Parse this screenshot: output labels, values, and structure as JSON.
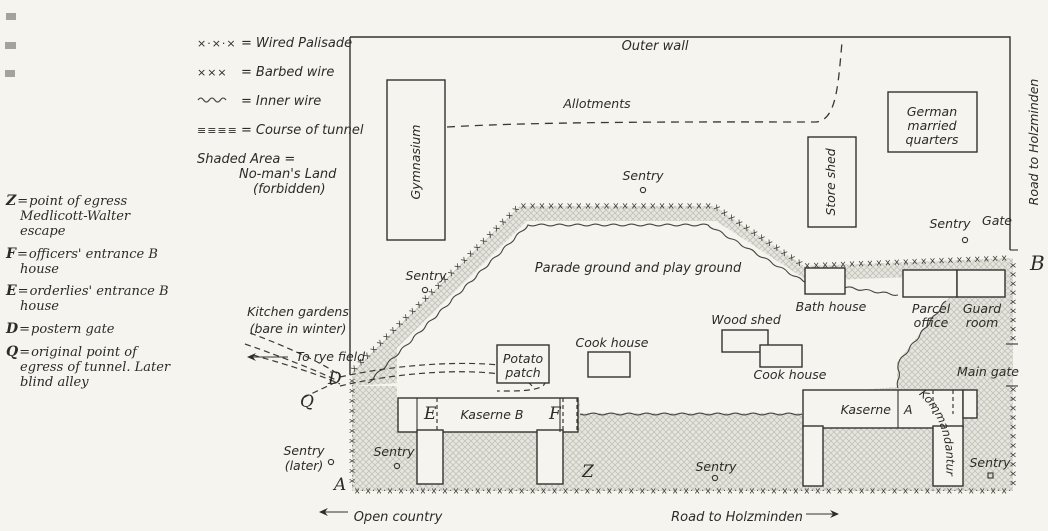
{
  "page": {
    "paper": "#f5f4ef",
    "ink": "#2c2b27",
    "shade_base": "#e6e5df",
    "shade_line": "#c3c2b8"
  },
  "legend_top": {
    "eq": "=",
    "items": [
      {
        "symbol": "×·×·×",
        "label": "Wired Palisade"
      },
      {
        "symbol": "×××",
        "label": "Barbed wire"
      },
      {
        "symbol": "~~~",
        "label": "Inner wire"
      },
      {
        "symbol": "≡≡≡≡",
        "label": "Course of tunnel"
      }
    ],
    "shaded": {
      "line1": "Shaded Area =",
      "line2": "No-man's Land",
      "line3": "(forbidden)"
    }
  },
  "legend_left": {
    "eq": "=",
    "items": [
      {
        "key": "Z",
        "text": "point of egress Medlicott-Walter escape"
      },
      {
        "key": "F",
        "text": "officers' entrance B house"
      },
      {
        "key": "E",
        "text": "orderlies' entrance B house"
      },
      {
        "key": "D",
        "text": "postern gate"
      },
      {
        "key": "Q",
        "text": "original point of egress of tunnel. Later blind alley"
      }
    ]
  },
  "map": {
    "symbols": {
      "barbed_unit": "×",
      "palisade_unit": "×·"
    },
    "labels": {
      "outer_wall": "Outer wall",
      "allotments": "Allotments",
      "gymnasium": "Gymnasium",
      "german_quarters": [
        "German",
        "married",
        "quarters"
      ],
      "road_to_holzminden": "Road to Holzminden",
      "gate": "Gate",
      "sentry": "Sentry",
      "sentry_later": [
        "Sentry",
        "(later)"
      ],
      "store_shed": "Store shed",
      "parade_ground": "Parade ground and play ground",
      "bath_house": "Bath house",
      "parcel_office": [
        "Parcel",
        "office"
      ],
      "guard_room": [
        "Guard",
        "room"
      ],
      "kitchen_gardens": [
        "Kitchen gardens",
        "(bare in winter)"
      ],
      "to_rye_field": "To rye field",
      "wood_shed": "Wood shed",
      "cook_house": "Cook house",
      "potato_patch": [
        "Potato",
        "patch"
      ],
      "main_gate": "Main gate",
      "kaserne_b": "Kaserne B",
      "kaserne_a_word": "Kaserne",
      "kaserne_a_letter": "A",
      "kommandantur": "Kommandantur",
      "open_country": "Open country"
    },
    "points": {
      "A": "A",
      "B": "B",
      "D": "D",
      "E": "E",
      "F": "F",
      "Q": "Q",
      "Z": "Z"
    }
  }
}
